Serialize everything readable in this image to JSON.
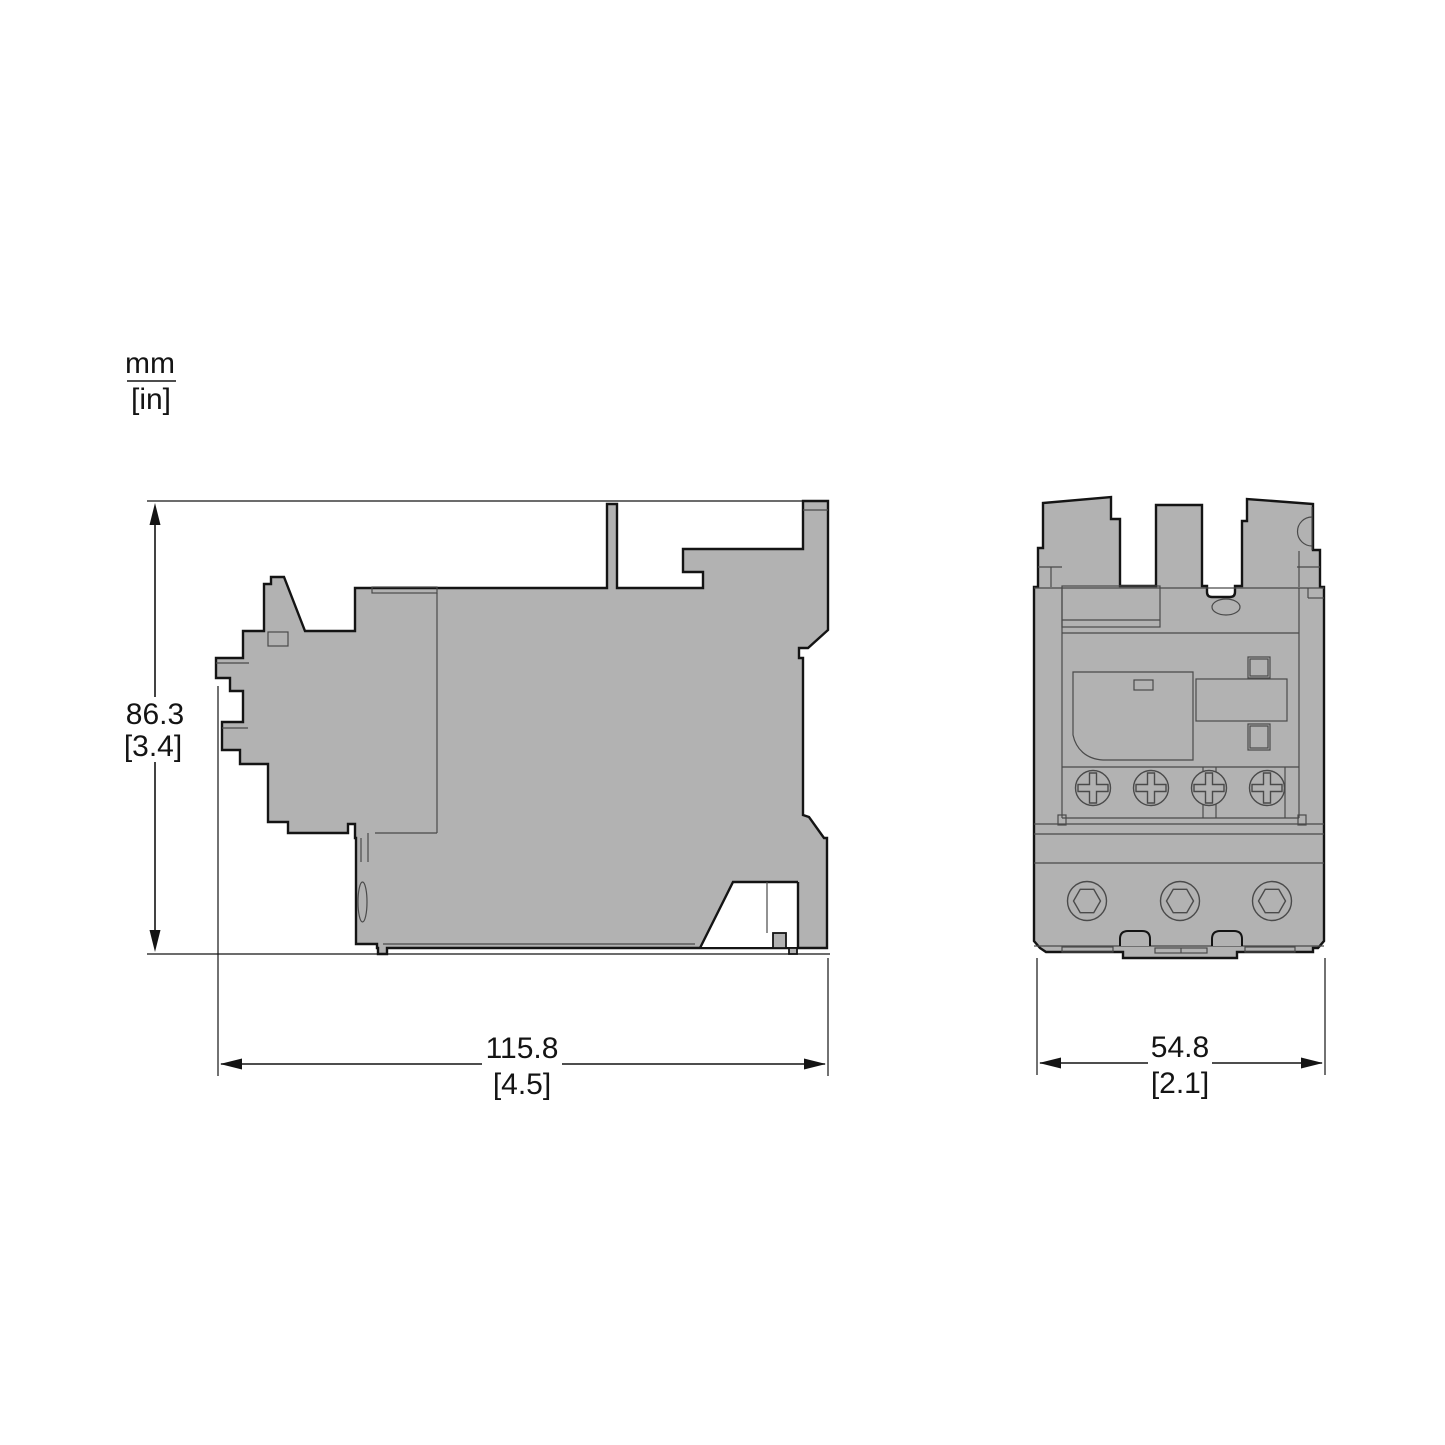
{
  "units_legend": {
    "primary": "mm",
    "secondary": "[in]"
  },
  "dimensions": {
    "side_height": {
      "mm": "86.3",
      "in": "[3.4]"
    },
    "side_width": {
      "mm": "115.8",
      "in": "[4.5]"
    },
    "front_width": {
      "mm": "54.8",
      "in": "[2.1]"
    }
  },
  "views": {
    "side": {
      "name": "side view of overload relay"
    },
    "front": {
      "name": "front view of overload relay"
    }
  },
  "colors": {
    "background": "#ffffff",
    "body_fill": "#b2b2b2",
    "outline": "#141414",
    "detail_line": "#4a4a4a",
    "dimension_line": "#141414"
  }
}
